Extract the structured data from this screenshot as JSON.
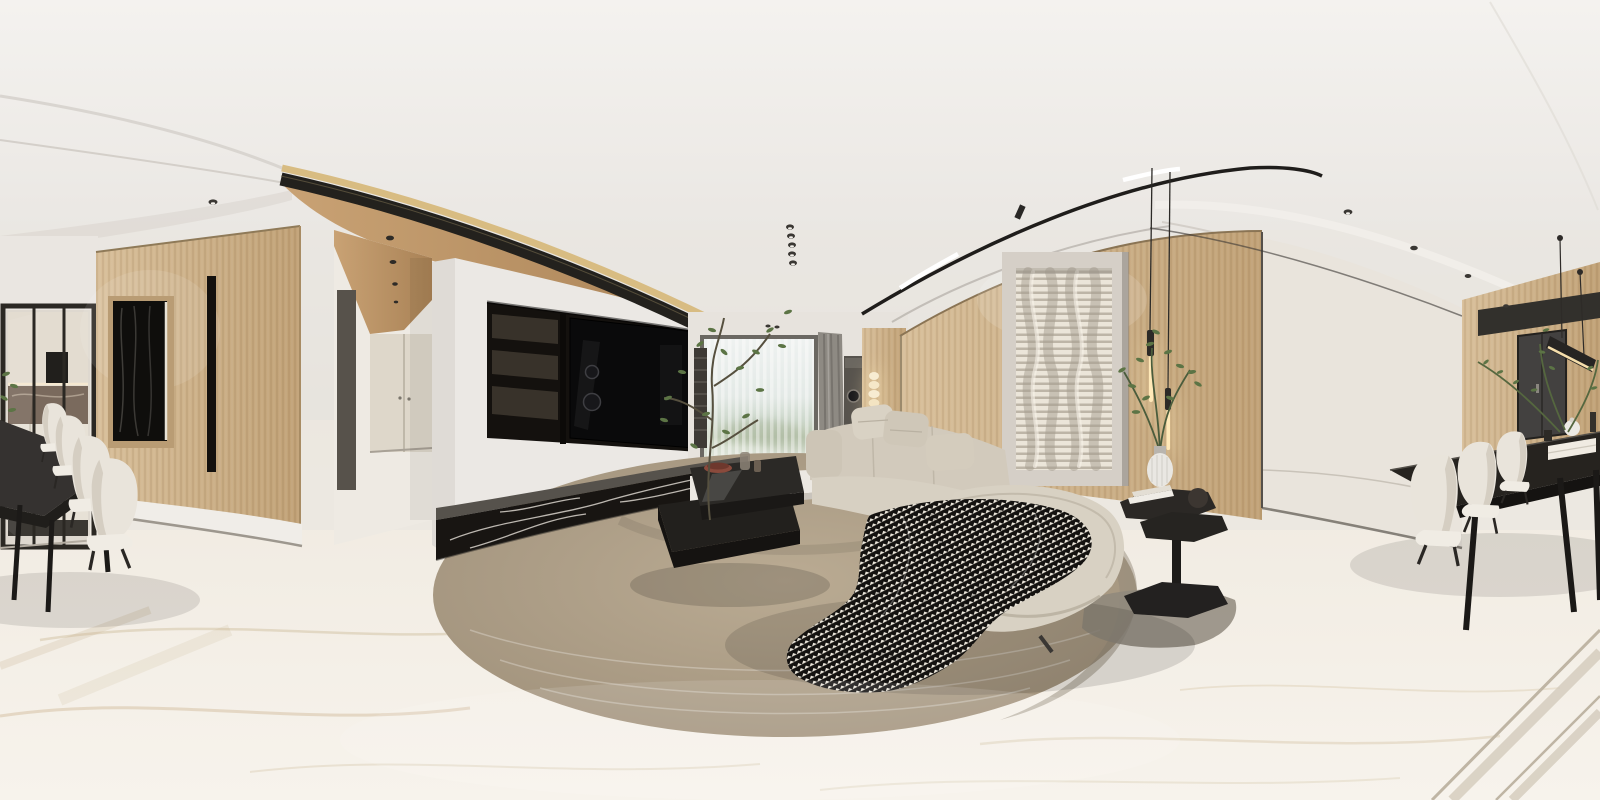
{
  "scene": {
    "title": "360-degree living and dining room panorama",
    "description": "Equirectangular 360-degree photorealistic render of a modern beige living room: wood-panel walls, recessed black TV niche over a veined black marble plinth, bright window with sheer curtains, modular beige sofa with houndstooth throw on a round textured rug, black two-tier coffee table with a tall plant, sculptural wavy white wall art with twin glowing pendant lights, and a black dining table with white upholstered chairs wrapping both image edges",
    "projection": "equirectangular",
    "style": "photorealistic interior render",
    "counts": {
      "left_dining_chairs": 4,
      "right_dining_chairs": 3,
      "sofa_pillows": 3,
      "pendant_tubes": 2,
      "ceiling_spot_column": 5,
      "hallway_spots": 4
    }
  },
  "palette": {
    "ceilTop": "#f4f2ef",
    "ceilBottom": "#e2ded9",
    "wall": "#eae6e1",
    "floorTop": "#efe9df",
    "floorBottom": "#f7f3ec",
    "wood": "#d8bf9a",
    "woodDeep": "#c1a277",
    "woodCeil": "#c9a274",
    "woodCeilDeep": "#a98256",
    "gold": "#d8bc82",
    "slat": "#23211d",
    "niche": "#14110e",
    "tv": "#0a0a0b",
    "shelf": "#38322a",
    "marble": "#181512",
    "marbleTop": "#56524c",
    "cream": "#e9e4dc",
    "door": "#434140",
    "tableDark": "#2a2723",
    "chair": "#e9e4db",
    "sofa": "#d7d0c2",
    "sofaDeep": "#c2b9a8",
    "rug": "#baab93",
    "rugDeep": "#9f907a",
    "throwLight": "#ebe6db",
    "throwDark": "#141210",
    "leaf": "#5c7445",
    "glow": "#f5deab",
    "curtain": "#8e8a83",
    "artBase": "#d5cfc7",
    "artSlat": "#ebe5d9"
  }
}
